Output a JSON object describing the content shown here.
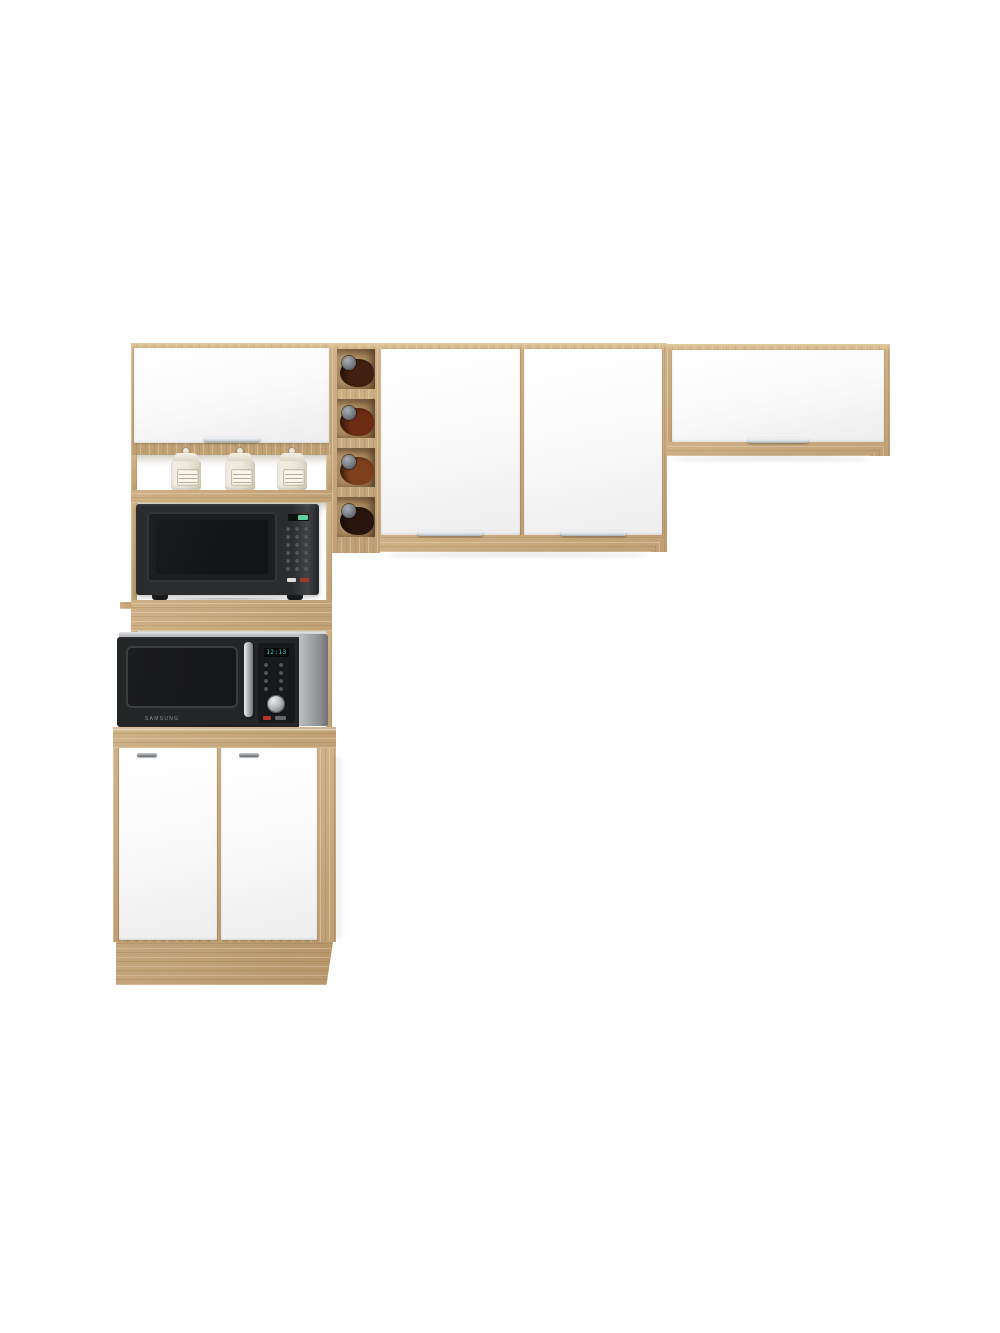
{
  "scene": {
    "background": "#ffffff"
  },
  "palette": {
    "wood": "#cbaa7c",
    "wood-light": "#e3cb9f",
    "wood-dark": "#a07c4a",
    "door-white": "#fbfbfc",
    "door-white-deep": "#ededee",
    "handle-silver": "#dde1e4",
    "mw1-body": "#2b2c2e",
    "mw1-side": "#404245",
    "mw1-screen": "#131416",
    "mw1-display": "#5fd0a0",
    "mw2-frame": "#c2c5c8",
    "mw2-door": "#232527",
    "mw2-screen": "#161719",
    "mw2-display": "#35dccd",
    "mw2-knob": "#b5b8bb",
    "canister": "#ece8db",
    "canister-deep": "#d8d2c0",
    "bottle-1": "#41200f",
    "bottle-2": "#6e2b14",
    "bottle-3": "#7e401c",
    "bottle-4": "#27150e",
    "cap-gray": "#6d7379"
  },
  "microwave_lower": {
    "brand": "SAMSUNG",
    "display": "12:13"
  },
  "wine_rack": {
    "bottle_count": 4
  },
  "open_shelf": {
    "canister_count": 3
  }
}
